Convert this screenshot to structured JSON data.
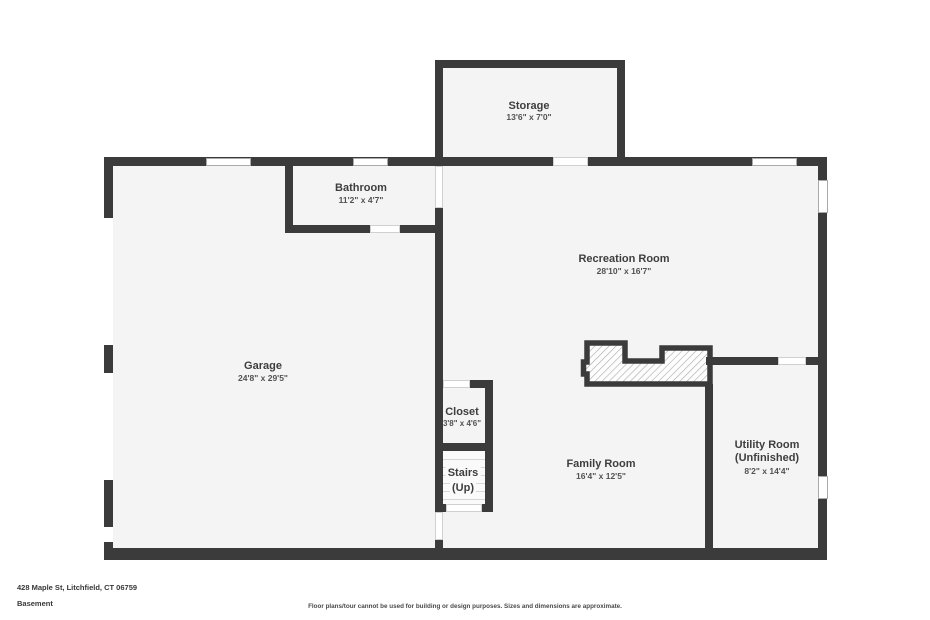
{
  "rooms": {
    "storage": {
      "name": "Storage",
      "dims": "13'6\" x 7'0\""
    },
    "bathroom": {
      "name": "Bathroom",
      "dims": "11'2\" x 4'7\""
    },
    "recreation": {
      "name": "Recreation Room",
      "dims": "28'10\" x 16'7\""
    },
    "garage": {
      "name": "Garage",
      "dims": "24'8\" x 29'5\""
    },
    "closet": {
      "name": "Closet",
      "dims": "3'8\" x 4'6\""
    },
    "stairs": {
      "name": "Stairs",
      "direction": "(Up)"
    },
    "family_room": {
      "name": "Family Room",
      "dims": "16'4\" x 12'5\""
    },
    "utility_room": {
      "name": "Utility Room",
      "status": "(Unfinished)",
      "dims": "8'2\" x 14'4\""
    }
  },
  "footer": {
    "address": "428 Maple St, Litchfield, CT 06759",
    "floor": "Basement",
    "disclaimer": "Floor plans/tour cannot be used for building or design purposes. Sizes and dimensions are approximate."
  },
  "colors": {
    "wall": "#3b3b3b",
    "room_fill": "#f4f4f4",
    "stairs_fill": "#fafafa",
    "hatch_line": "#a9a9a9",
    "window_border": "#a9a9a9",
    "door_border": "#d0d0d0",
    "text": "#3e3e3e"
  }
}
